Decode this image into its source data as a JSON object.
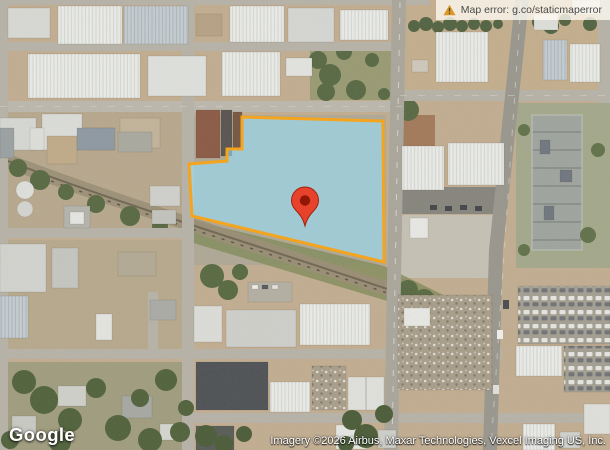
{
  "overlays": {
    "error_banner": {
      "text": "Map error: g.co/staticmaperror",
      "icon": "warning-triangle-icon"
    },
    "logo": "Google",
    "attribution": "Imagery ©2026 Airbus, Maxar Technologies, Vexcel Imaging US, Inc."
  },
  "parcel": {
    "points": "242,117 383,121 384,262 192,216 189,164 227,161 227,149 242,149",
    "fill": "rgba(150,225,255,0.58)",
    "stroke": "#F4A41D",
    "stroke_width": "3"
  },
  "marker": {
    "transform": "translate(305,226)",
    "body_color": "#E7422C",
    "border_color": "#A2210D",
    "dot_color": "#911605"
  },
  "colors": {
    "banner_bg": "rgba(255,252,243,0.78)",
    "banner_text": "#4A4A4A",
    "warning_icon": "#D99A2B",
    "overlay_text": "#FFFFFF"
  }
}
